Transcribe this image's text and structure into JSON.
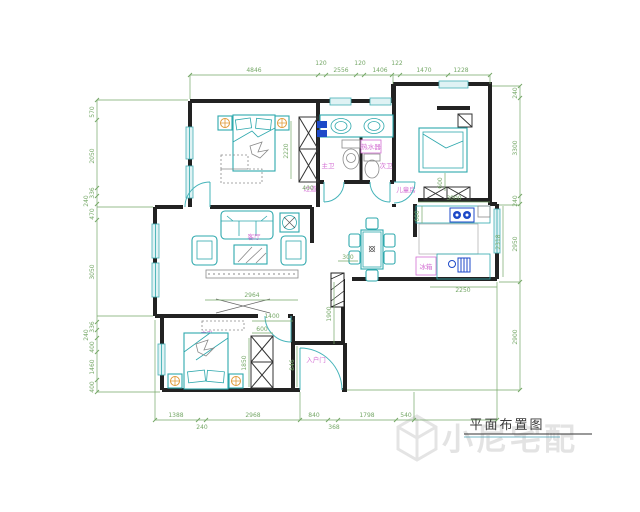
{
  "drawing": {
    "title": "平面布置图",
    "watermark": "小尼宅配"
  },
  "labels": {
    "living_room": "客厅",
    "master_bedroom": "主卧",
    "hallway": "过道",
    "kids_room": "儿童房",
    "master_bath": "主卫",
    "second_bath": "次卫",
    "water_heater": "热水器",
    "fridge": "冰箱",
    "entry_door": "入户门"
  },
  "dims": {
    "top": [
      "4846",
      "120",
      "2556",
      "120",
      "1406",
      "122",
      "1470",
      "1228"
    ],
    "left": [
      "570",
      "2050",
      "336",
      "240",
      "470",
      "3050",
      "336",
      "240",
      "400",
      "1460",
      "400"
    ],
    "right": [
      "240",
      "3300",
      "240",
      "2950",
      "2900"
    ],
    "bottom": [
      "1388",
      "240",
      "2968",
      "840",
      "368",
      "1798",
      "540"
    ],
    "inner": {
      "living_width": "2964",
      "hall_height": "1900",
      "dining_gap": "300",
      "kitchen_width": "3000",
      "kitchen_left": "600",
      "kitchen_height": "2318",
      "kitchen_bottom": "2250",
      "kids_gap": "600",
      "bed2_height": "2220",
      "bed2_gap": "400",
      "bed1_width": "1400",
      "bed1_cabinet": "600",
      "bed1_height": "1850",
      "entry_height": "846"
    }
  }
}
